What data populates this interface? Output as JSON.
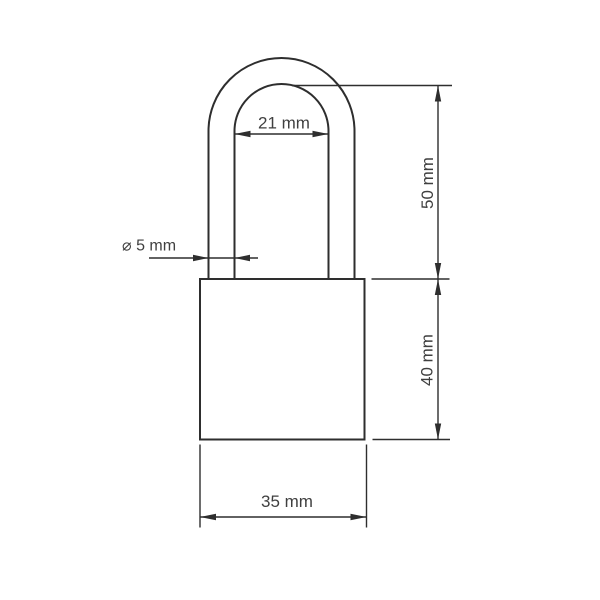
{
  "style": {
    "line_color": "#2e2e2e",
    "text_color": "#3f3f3f",
    "bg_color": "#ffffff"
  },
  "drawing": {
    "kind": "technical-dimension-drawing",
    "subject": "padlock-front-view",
    "dimensions": {
      "shackle_inner_width": {
        "label": "21 mm",
        "value": 21,
        "unit": "mm"
      },
      "shackle_diameter": {
        "label": "⌀ 5 mm",
        "value": 5,
        "unit": "mm"
      },
      "shackle_height": {
        "label": "50 mm",
        "value": 50,
        "unit": "mm"
      },
      "body_height": {
        "label": "40 mm",
        "value": 40,
        "unit": "mm"
      },
      "body_width": {
        "label": "35 mm",
        "value": 35,
        "unit": "mm"
      }
    }
  }
}
